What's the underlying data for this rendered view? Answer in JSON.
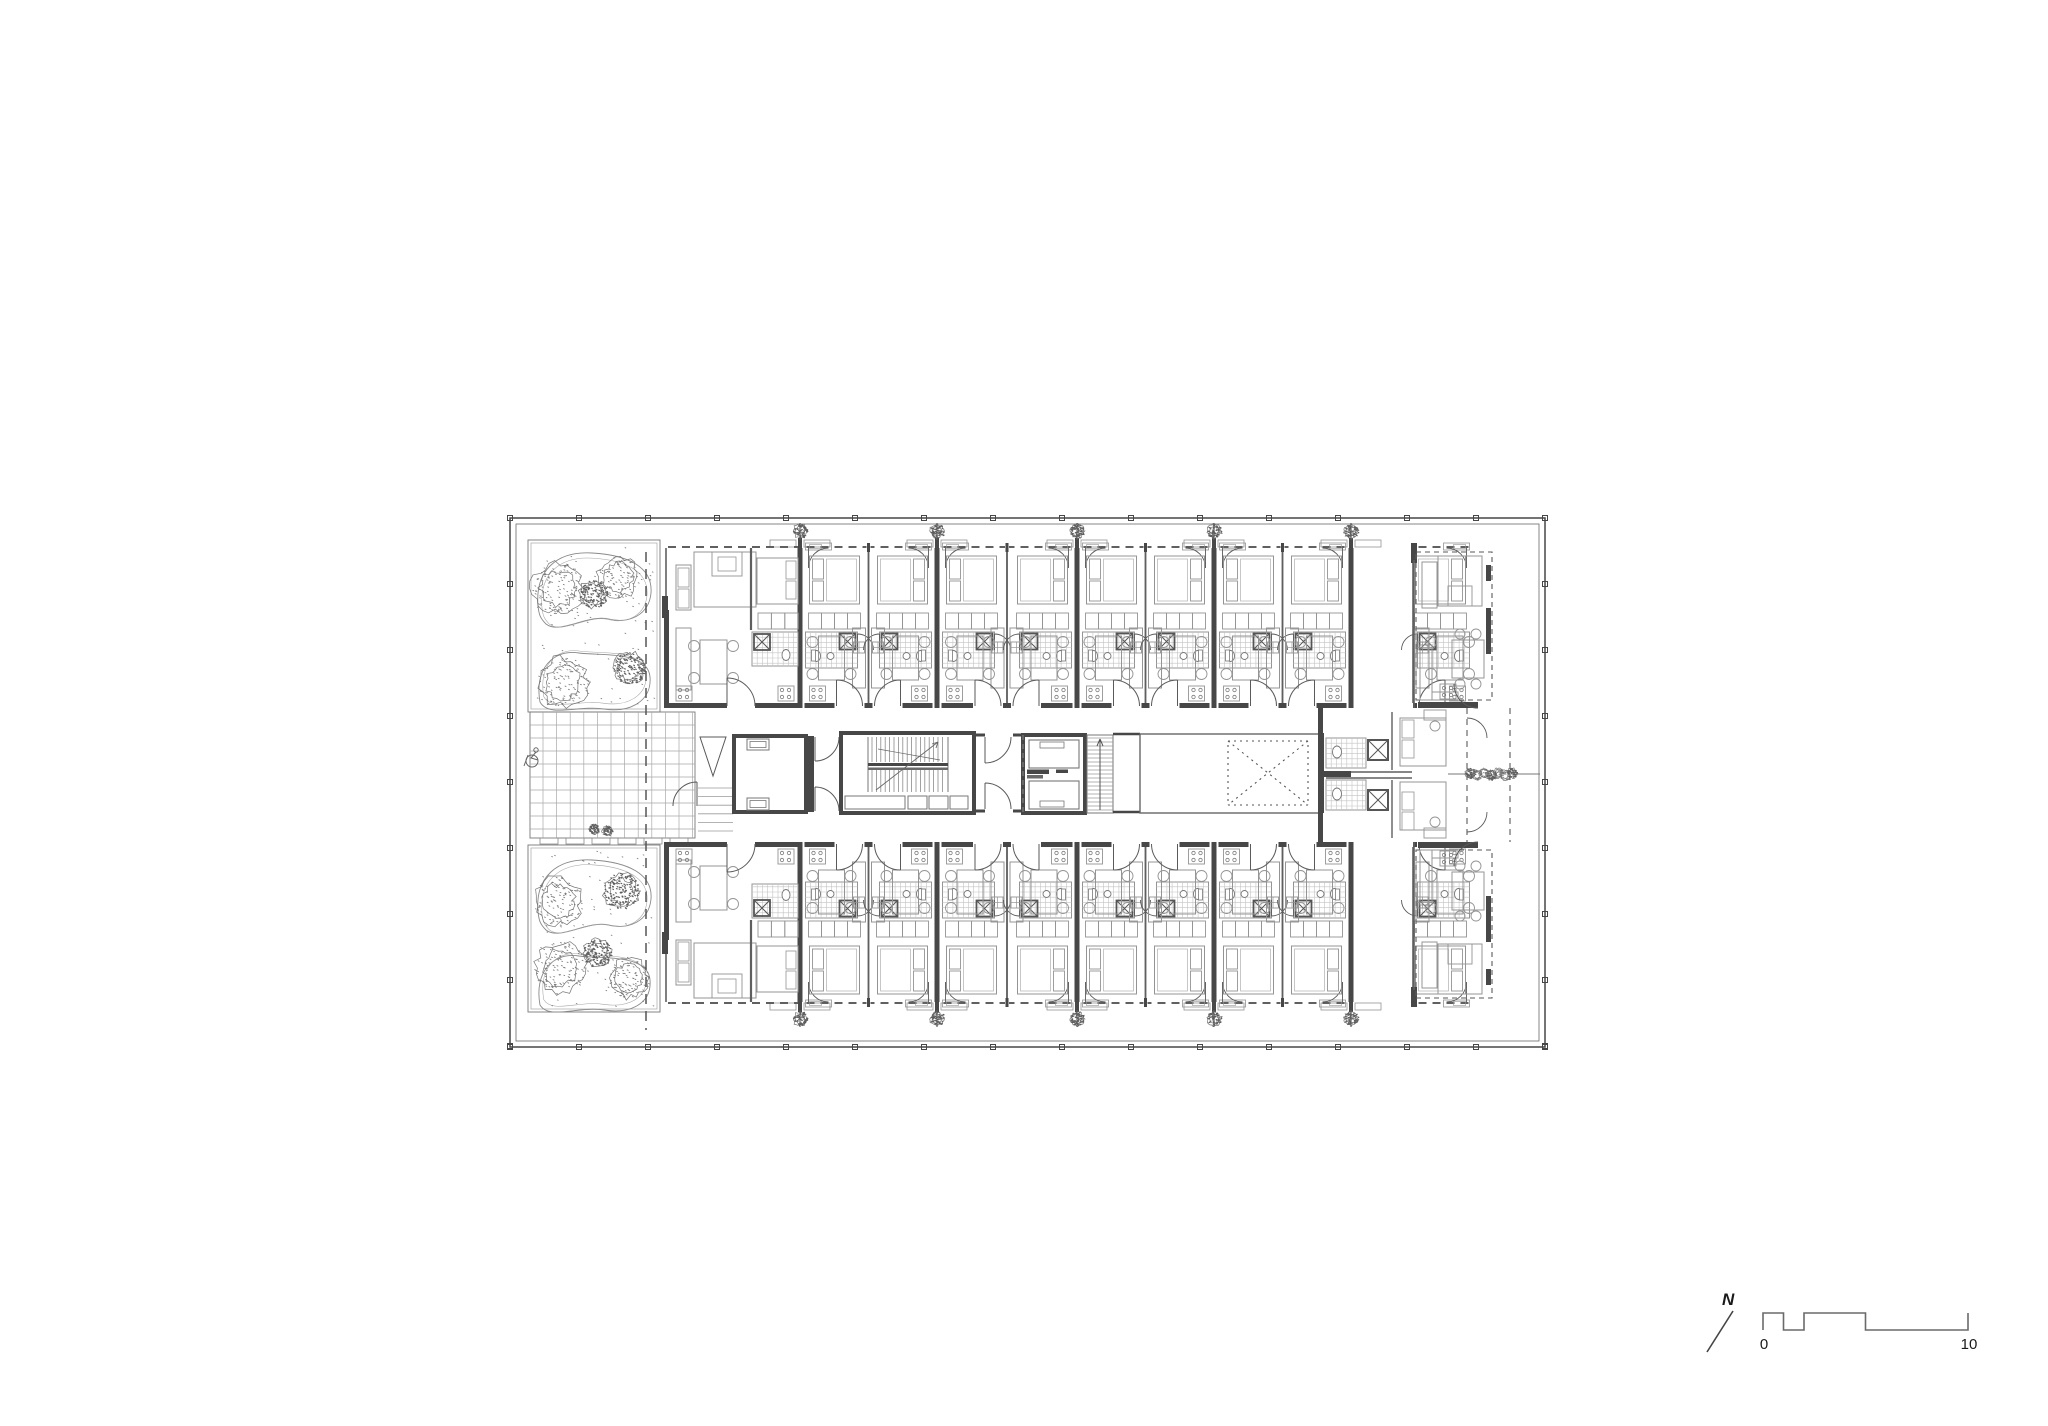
{
  "document": {
    "type": "architectural floor plan",
    "background": "#ffffff"
  },
  "north_indicator": {
    "label": "N"
  },
  "scale_bar": {
    "start_label": "0",
    "end_label": "10",
    "segments_m": [
      1,
      1,
      3,
      5
    ],
    "total_m": 10,
    "px_per_m": 20.5
  },
  "colors": {
    "wall": "#474747",
    "line": "#5a5a5a",
    "furniture": "#949494",
    "hatch": "#c3c3c3",
    "grid": "#a8a8a8",
    "vegetation": "#757575",
    "vegetation_dense": "#5e5e5e",
    "text": "#1a1a1a",
    "background": "#ffffff"
  },
  "plan": {
    "party_wall_count": 5,
    "studio_pairs": 4,
    "facade_planters_per_side": 5,
    "elevator_count": 2,
    "stair_flights": 2,
    "roof_gardens": 2,
    "trees_per_garden": 5
  }
}
